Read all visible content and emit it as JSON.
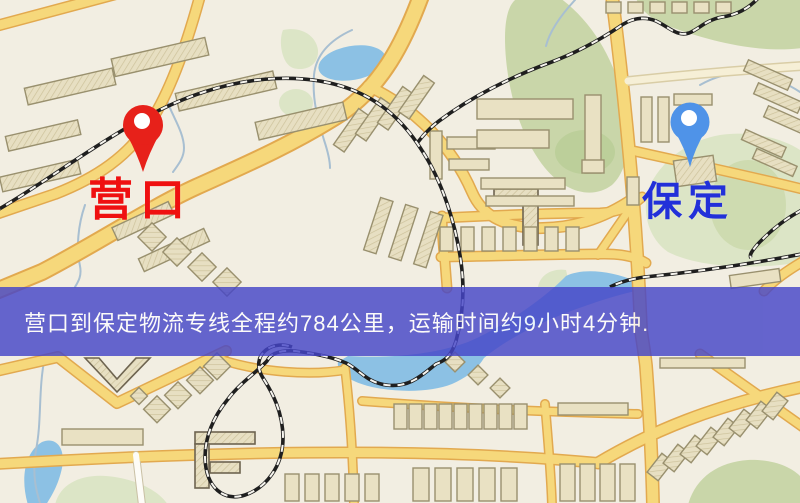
{
  "page": {
    "width": 800,
    "height": 503,
    "kind": "logistics-route-map"
  },
  "map": {
    "markers": [
      {
        "id": "origin",
        "label": "营口",
        "x": 143,
        "y": 125
      },
      {
        "id": "destination",
        "label": "保定",
        "x": 690,
        "y": 122
      }
    ],
    "banner": {
      "text": "营口到保定物流专线全程约784公里，运输时间约9小时4分钟."
    },
    "route": {
      "from": "营口",
      "to": "保定",
      "distance_km_text": "约784公里",
      "duration_text": "约9小时4分钟"
    },
    "colors": {
      "bg": "#f2eee2",
      "road": "#f6d87b",
      "road-casing": "#e2a94f",
      "building": "#e9e1c3",
      "building-outline": "#99906e",
      "park": "#c9d6a9",
      "park-pale": "#dce5c6",
      "water": "#8cc1e4",
      "stream": "#a8bfd1",
      "railway": "#1f1f1f",
      "banner-bg": "#4646c8",
      "banner-text": "#ffffff",
      "origin-label": "#ef1010",
      "destination-label": "#2230d9",
      "pin-red": "#e7211a",
      "pin-blue": "#4f93e8"
    }
  }
}
